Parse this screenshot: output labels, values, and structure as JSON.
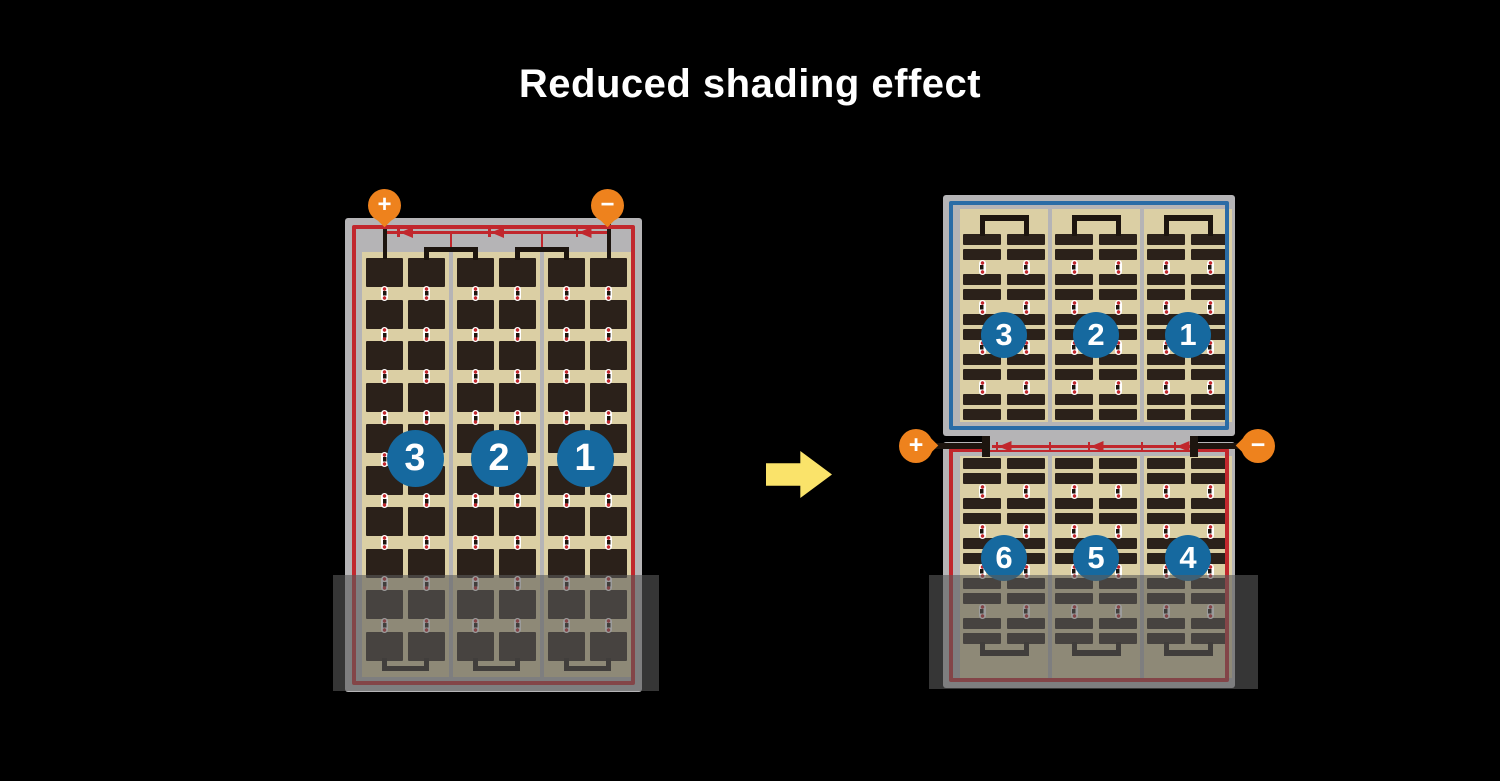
{
  "title": "Reduced shading effect",
  "colors": {
    "background": "#000000",
    "frame_gray": "#b5b4b6",
    "cell_tan": "#dbcfa4",
    "cell_dark": "#2b211a",
    "wire_black": "#1d150f",
    "circuit_red": "#c1272d",
    "border_blue": "#2a6ca6",
    "label_blue": "#16699f",
    "terminal_orange": "#ee821d",
    "arrow_yellow": "#fae36a",
    "dot_white": "#ffffff",
    "shade": "rgba(90,90,90,0.6)"
  },
  "left_panel": {
    "terminals": {
      "positive": "+",
      "negative": "−"
    },
    "string_labels": [
      "3",
      "2",
      "1"
    ]
  },
  "right_panel": {
    "terminals": {
      "positive": "+",
      "negative": "−"
    },
    "top_string_labels": [
      "3",
      "2",
      "1"
    ],
    "bottom_string_labels": [
      "6",
      "5",
      "4"
    ]
  },
  "figure": {
    "left_panel": {
      "strings": 3,
      "subcolumns_per_string": 2,
      "cell_rows": 10,
      "bypass_diodes": 3
    },
    "right_modules": {
      "strings": 3,
      "subcolumns_per_string": 2,
      "bar_groups": 5,
      "bars_per_group": 2,
      "bypass_diodes": 3
    }
  }
}
